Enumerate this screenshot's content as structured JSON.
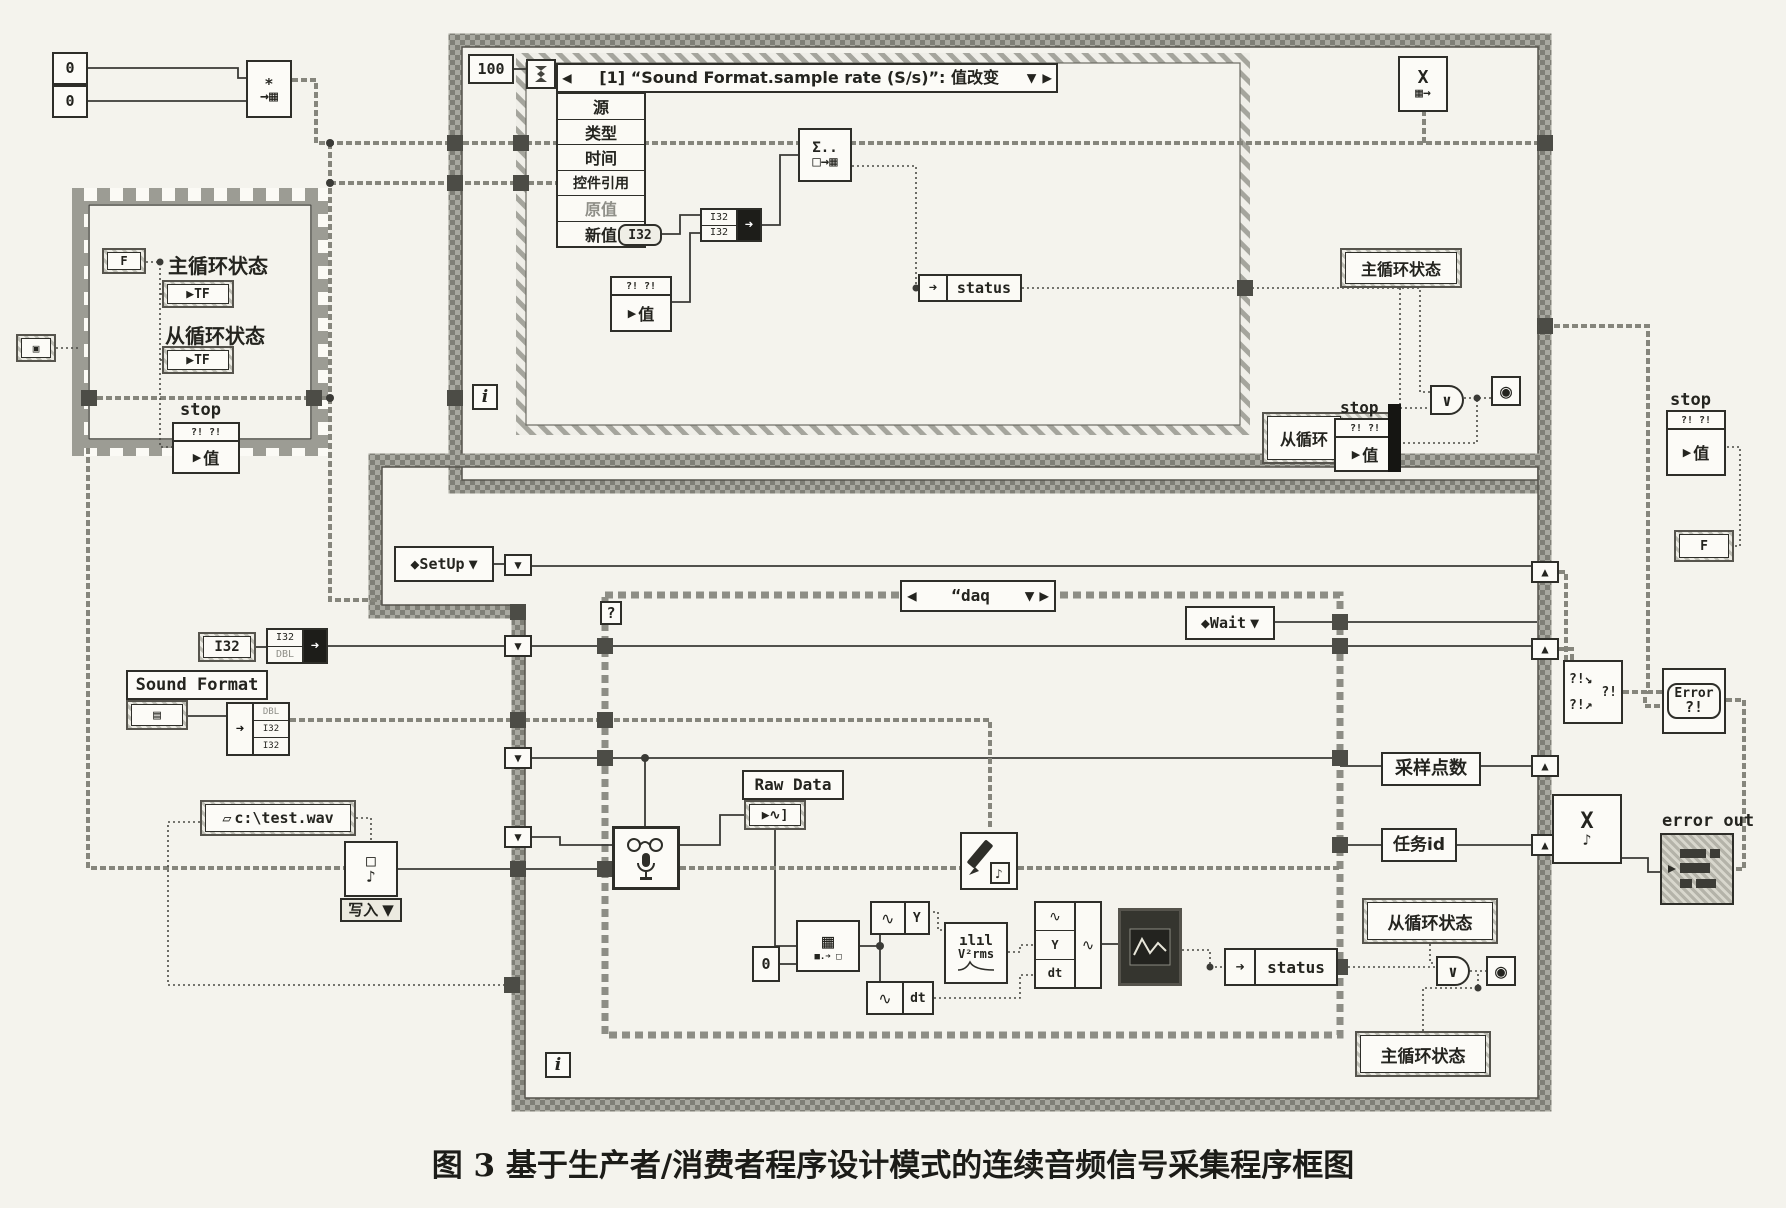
{
  "caption": "图 3  基于生产者/消费者程序设计模式的连续音频信号采集程序框图",
  "colors": {
    "paper": "#f4f3ed",
    "ink": "#2e2e29",
    "border_gray": "#8d8d85",
    "hatch_gray": "#a5a59d"
  },
  "top_left": {
    "const_a": "0",
    "const_b": "0",
    "obtain_glyph_top": "∗",
    "obtain_glyph_bottom": "→▦"
  },
  "release_node": {
    "glyph_top": "X",
    "glyph_bottom": "▦→"
  },
  "event_loop": {
    "timeout": "100",
    "header": "[1] “Sound Format.sample rate (S/s)”: 值改变",
    "header_left": "◀",
    "header_drop": "▼",
    "header_right": "▶",
    "fields": [
      "源",
      "类型",
      "时间",
      "控件引用",
      "原值",
      "新值"
    ],
    "new_value_type": "I32",
    "conv_top": "I32",
    "conv_bottom": "I32",
    "enqueue_top": "Σ..",
    "enqueue_bottom": "□→▦",
    "value_header": "?! ?!",
    "value_label": "值",
    "status": "status",
    "main_state": "主循环状态",
    "sub_state": "从循环",
    "stop": "stop",
    "iteration": "i",
    "or": "∨"
  },
  "sequence": {
    "ext_glyph": "▣",
    "f_const": "F",
    "main_state": "主循环状态",
    "tf": "TF",
    "sub_state": "从循环状态",
    "tf2": "TF",
    "stop": "stop",
    "value_header": "?! ?!",
    "value": "值"
  },
  "producer": {
    "setup": "◆SetUp",
    "setup_drop": "▼",
    "case_left": "◀",
    "case_name": "“daq",
    "case_drop": "▼",
    "case_right": "▶",
    "case_q": "?",
    "wait": "◆Wait",
    "wait_drop": "▼",
    "i32": "I32",
    "conv_top": "I32",
    "conv_bottom": "DBL",
    "sound_format": "Sound Format",
    "sf_glyph": "▤",
    "unbundle": [
      "DBL",
      "I32",
      "I32"
    ],
    "path": "c:\\test.wav",
    "write_label": "写入",
    "write_drop": "▼",
    "write_glyph_top": "□",
    "write_glyph_bottom": "♪",
    "raw_data": "Raw Data",
    "raw_local": "▶∿]",
    "zero": "0",
    "index_glyph": "▦",
    "wave": "∿",
    "y": "Y",
    "dt": "dt",
    "amp_top": "ılıl",
    "amp_bottom": "V²rms",
    "graph_glyph": "∿",
    "status": "status",
    "samples": "采样点数",
    "task_id": "任务id",
    "sub_state": "从循环状态",
    "main_state": "主循环状态",
    "iteration": "i",
    "or": "∨"
  },
  "right_rail": {
    "stop": "stop",
    "value_header": "?! ?!",
    "value": "值",
    "tf": "F",
    "merge_a": "?!↘",
    "merge_b": "?!↗",
    "merge_c": "?!",
    "close_top": "X",
    "close_bottom": "♪",
    "error_line1": "Error",
    "error_line2": "?!",
    "error_out": "error out"
  }
}
